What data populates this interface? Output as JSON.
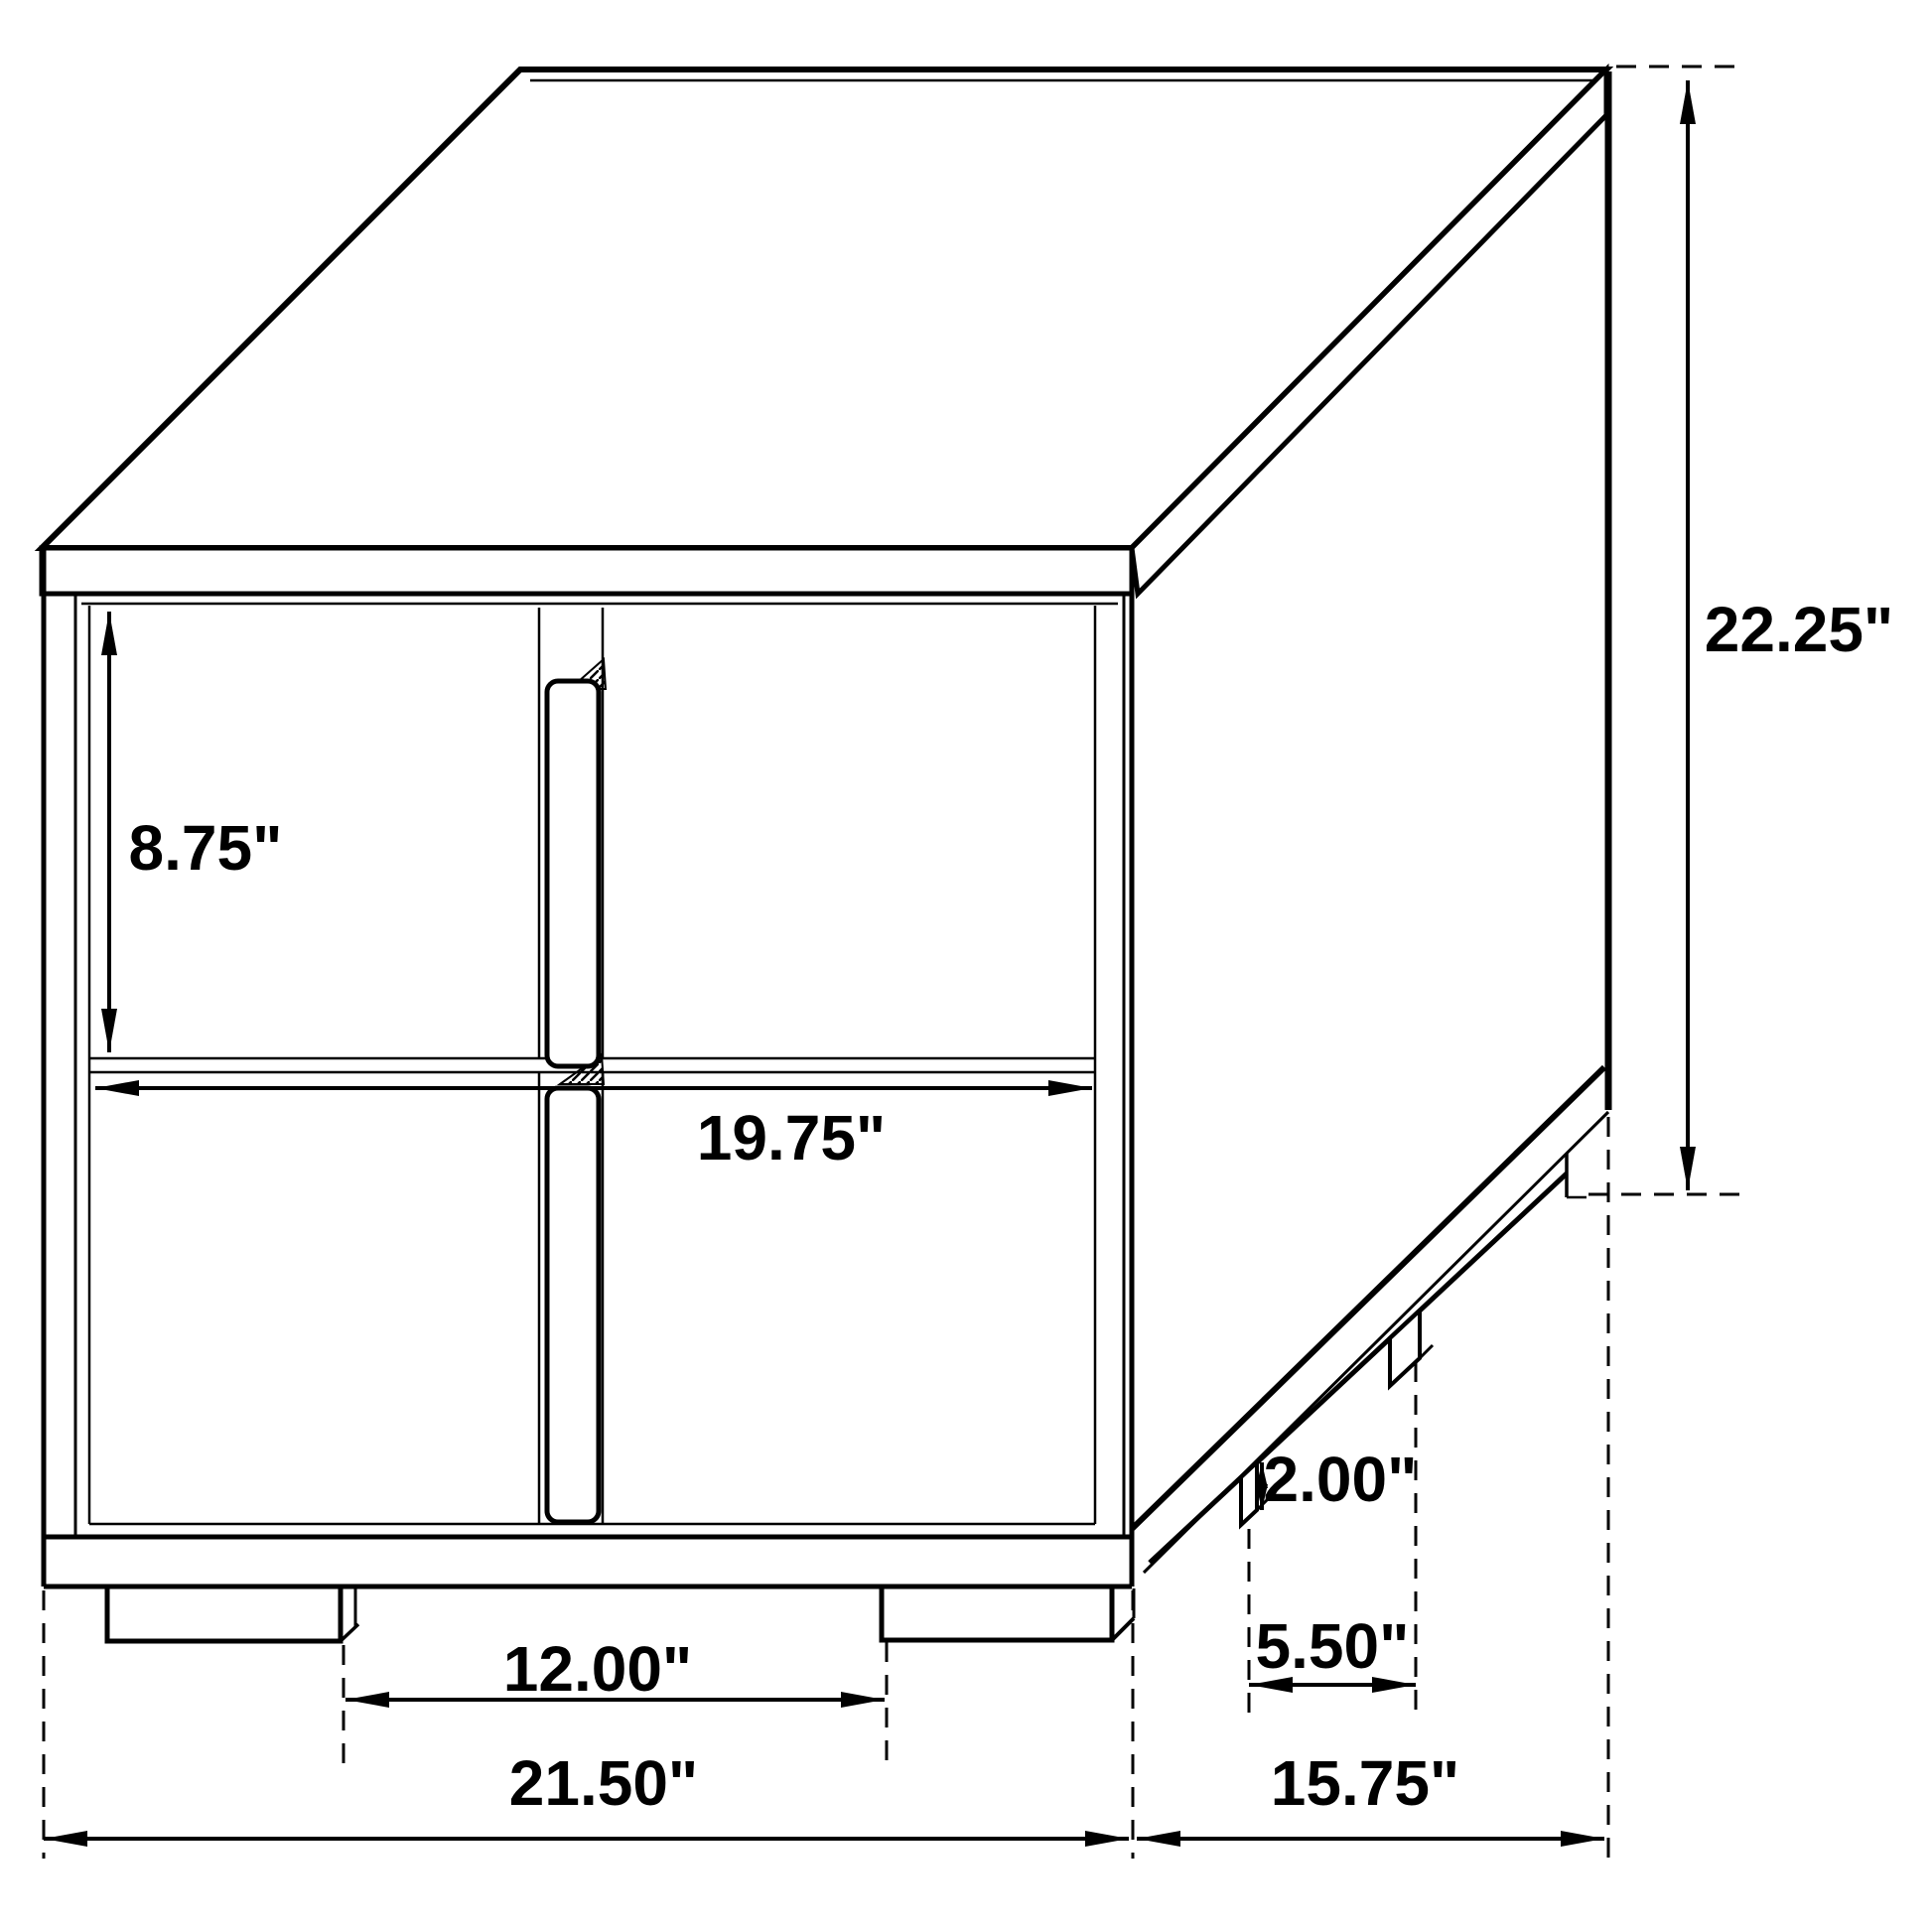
{
  "page": {
    "background_color": "#ffffff",
    "line_color": "#000000"
  },
  "diagram": {
    "unit": "inches",
    "labels": {
      "drawer_height": "8.75\"",
      "drawer_width": "19.75\"",
      "overall_height": "22.25\"",
      "leg_height": "2.00\"",
      "side_leg_spacing": "5.50\"",
      "front_leg_spacing": "12.00\"",
      "overall_width": "21.50\"",
      "overall_depth": "15.75\""
    }
  }
}
